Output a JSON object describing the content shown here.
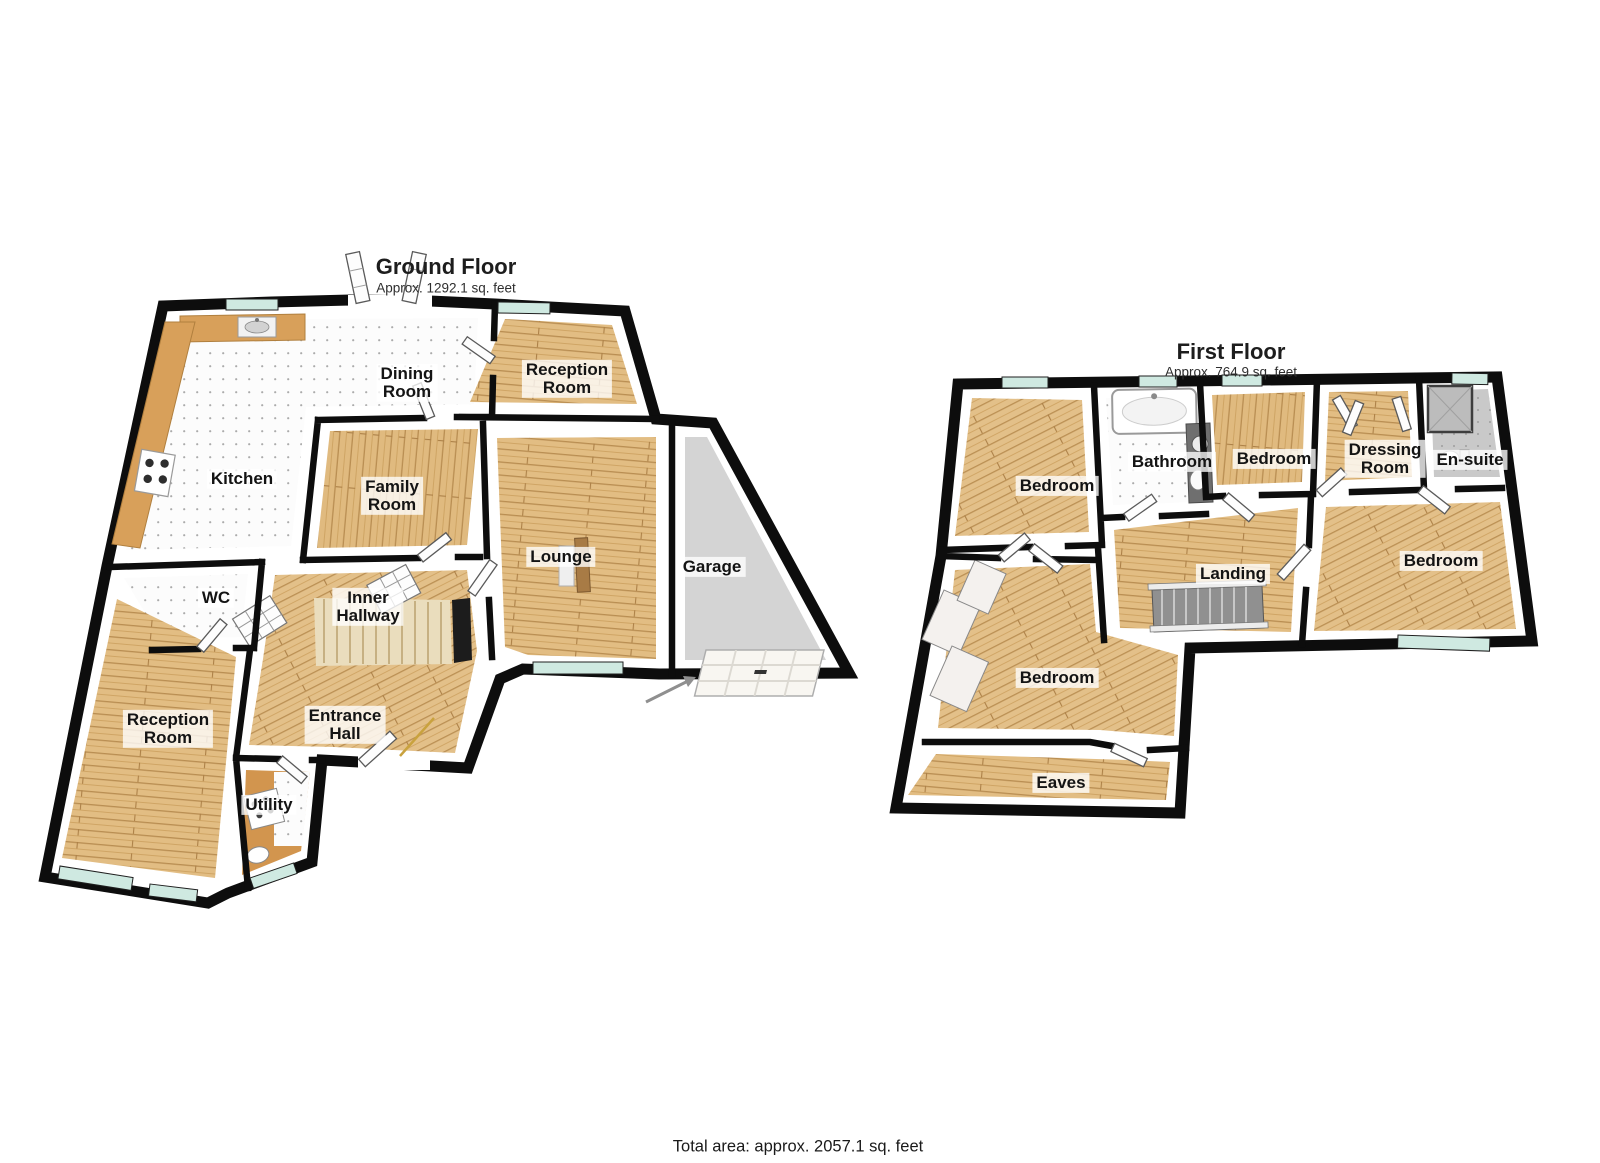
{
  "ground_floor": {
    "title": "Ground Floor",
    "area_label": "Approx. 1292.1 sq. feet",
    "rooms": [
      {
        "label": "Dining\nRoom"
      },
      {
        "label": "Reception\nRoom"
      },
      {
        "label": "Kitchen"
      },
      {
        "label": "Family\nRoom"
      },
      {
        "label": "Lounge"
      },
      {
        "label": "Garage"
      },
      {
        "label": "WC"
      },
      {
        "label": "Inner\nHallway"
      },
      {
        "label": "Entrance\nHall"
      },
      {
        "label": "Reception\nRoom"
      },
      {
        "label": "Utility"
      }
    ]
  },
  "first_floor": {
    "title": "First Floor",
    "area_label": "Approx. 764.9 sq. feet",
    "rooms": [
      {
        "label": "Bedroom"
      },
      {
        "label": "Bathroom"
      },
      {
        "label": "Bedroom"
      },
      {
        "label": "Dressing\nRoom"
      },
      {
        "label": "En-suite"
      },
      {
        "label": "Bedroom"
      },
      {
        "label": "Landing"
      },
      {
        "label": "Bedroom"
      },
      {
        "label": "Eaves"
      }
    ]
  },
  "footer": {
    "total_area": "Total area: approx. 2057.1 sq. feet"
  },
  "colors": {
    "wall": "#0d0d0d",
    "wood_base": "#e2bd83",
    "wood_line": "#b98e52",
    "tile_base": "#fcfcfc",
    "tile_dot": "#ababab",
    "window_glass": "#cfe9e1",
    "garage_floor": "#d4d4d4",
    "ensuite_floor": "#c9c9c9",
    "utility_floor": "#d2954e",
    "stair_tread": "#eaddbd",
    "counter": "#d8a05a",
    "label_bg": "rgba(255,255,255,0.78)",
    "text": "#141414"
  }
}
